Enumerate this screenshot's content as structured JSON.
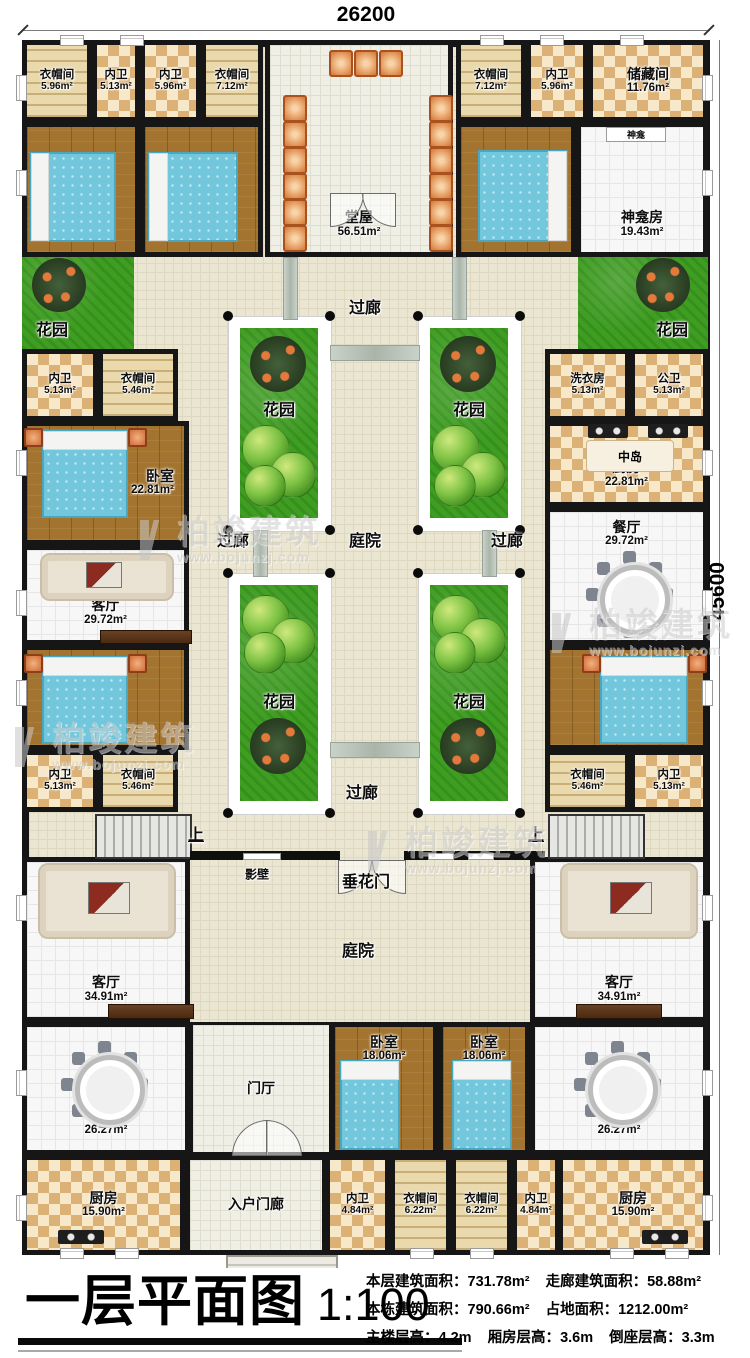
{
  "title": {
    "name": "一层平面图",
    "scale": "1:100"
  },
  "dims": {
    "width": "26200",
    "height": "45600"
  },
  "stats": [
    [
      {
        "k": "本层建筑面积：",
        "v": "731.78m²"
      },
      {
        "k": "走廊建筑面积：",
        "v": "58.88m²"
      }
    ],
    [
      {
        "k": "本栋建筑面积：",
        "v": "790.66m²"
      },
      {
        "k": "占地面积：",
        "v": "1212.00m²"
      }
    ],
    [
      {
        "k": "主楼层高：",
        "v": "4.2m"
      },
      {
        "k": "厢房层高：",
        "v": "3.6m"
      },
      {
        "k": "倒座层高：",
        "v": "3.3m"
      }
    ]
  ],
  "labels": {
    "guolang": "过廊",
    "tingyuan": "庭院",
    "huayuan": "花园",
    "zhongdao": "中岛",
    "shenkan": "神龛",
    "yingbi": "影壁",
    "chuihuamen": "垂花门",
    "shang": "上"
  },
  "watermark": {
    "name": "柏竣建筑",
    "url": "www.bojunzj.com"
  },
  "rooms": [
    {
      "n": "衣帽间",
      "a": "5.96m²"
    },
    {
      "n": "内卫",
      "a": "5.13m²"
    },
    {
      "n": "内卫",
      "a": "5.96m²"
    },
    {
      "n": "衣帽间",
      "a": "7.12m²"
    },
    {
      "n": "卧室",
      "a": "19.43m²"
    },
    {
      "n": "卧室",
      "a": "26.05m²"
    },
    {
      "n": "堂屋",
      "a": "56.51m²"
    },
    {
      "n": "衣帽间",
      "a": "7.12m²"
    },
    {
      "n": "内卫",
      "a": "5.96m²"
    },
    {
      "n": "储藏间",
      "a": "11.76m²"
    },
    {
      "n": "卧室",
      "a": "26.05m²"
    },
    {
      "n": "神龛房",
      "a": "19.43m²"
    },
    {
      "n": "内卫",
      "a": "5.13m²"
    },
    {
      "n": "衣帽间",
      "a": "5.46m²"
    },
    {
      "n": "卧室",
      "a": "22.81m²"
    },
    {
      "n": "客厅",
      "a": "29.72m²"
    },
    {
      "n": "卧室",
      "a": "22.81m²"
    },
    {
      "n": "内卫",
      "a": "5.13m²"
    },
    {
      "n": "衣帽间",
      "a": "5.46m²"
    },
    {
      "n": "洗衣房",
      "a": "5.13m²"
    },
    {
      "n": "公卫",
      "a": "5.13m²"
    },
    {
      "n": "厨房",
      "a": "22.81m²"
    },
    {
      "n": "餐厅",
      "a": "29.72m²"
    },
    {
      "n": "卧室",
      "a": "22.81m²"
    },
    {
      "n": "衣帽间",
      "a": "5.46m²"
    },
    {
      "n": "内卫",
      "a": "5.13m²"
    },
    {
      "n": "客厅",
      "a": "34.91m²"
    },
    {
      "n": "餐厅",
      "a": "26.27m²"
    },
    {
      "n": "厨房",
      "a": "15.90m²"
    },
    {
      "n": "客厅",
      "a": "34.91m²"
    },
    {
      "n": "餐厅",
      "a": "26.27m²"
    },
    {
      "n": "厨房",
      "a": "15.90m²"
    },
    {
      "n": "卧室",
      "a": "18.06m²"
    },
    {
      "n": "卧室",
      "a": "18.06m²"
    },
    {
      "n": "内卫",
      "a": "4.84m²"
    },
    {
      "n": "衣帽间",
      "a": "6.22m²"
    },
    {
      "n": "衣帽间",
      "a": "6.22m²"
    },
    {
      "n": "内卫",
      "a": "4.84m²"
    },
    {
      "n": "门厅",
      "a": ""
    },
    {
      "n": "入户门廊",
      "a": ""
    }
  ]
}
